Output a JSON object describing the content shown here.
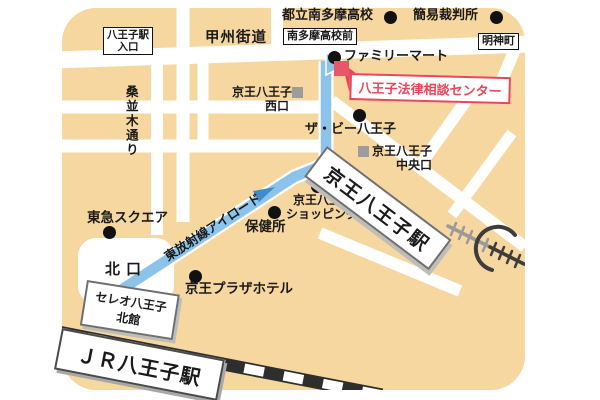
{
  "colors": {
    "map_background": "#f7d7a0",
    "road": "#ffffff",
    "route_blue": "#8cc3ea",
    "route_arrow_blue": "#3e8ccb",
    "destination_red": "#e8465a",
    "destination_marker_pink": "#e8566b",
    "rail_dark": "#3d3d3d",
    "rail_light": "#9a9a9a"
  },
  "streets": {
    "koshu_kaido": "甲州街道",
    "kuwanamiki_dori": "桑並木通り",
    "higashi_hoshasen_airoad": "東放射線アイロード"
  },
  "area_labels": {
    "hachioji_eki_iriguchi_l1": "八王子駅",
    "hachioji_eki_iriguchi_l2": "入口",
    "minamitama_kokomae": "南多摩高校前",
    "myojincho": "明神町",
    "kitaguchi": "北口"
  },
  "landmarks": {
    "toritsu_minamitama_hs": "都立南多摩高校",
    "kani_saibansho": "簡易裁判所",
    "familymart": "ファミリーマート",
    "the_b_hachioji": "ザ・ビー八王子",
    "keio_west_l1": "京王八王子",
    "keio_west_l2": "西口",
    "keio_central_l1": "京王八王子",
    "keio_central_l2": "中央口",
    "tokyu_square": "東急スクエア",
    "hokenjo": "保健所",
    "keio_sc_l1": "京王八王子",
    "keio_sc_l2": "ショッピングセンター",
    "keio_plaza_hotel": "京王プラザホテル"
  },
  "stations": {
    "keio_hachioji": "京王八王子駅",
    "jr_hachioji": "ＪＲ八王子駅",
    "celeo_l1": "セレオ八王子",
    "celeo_l2": "北館"
  },
  "destination": {
    "name": "八王子法律相談センター"
  }
}
